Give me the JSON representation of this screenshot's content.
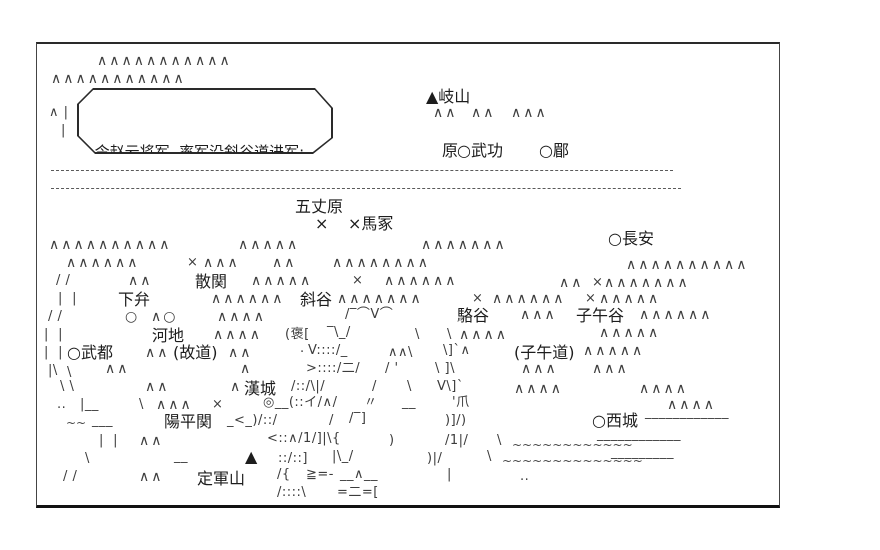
{
  "colors": {
    "ink": "#1d1d1d",
    "art": "#3c3c3c",
    "border": "#2a2a2a",
    "background": "#ffffff"
  },
  "map": {
    "frame": {
      "x": 36,
      "y": 42,
      "w": 744,
      "h": 466
    },
    "speech_bubble": {
      "x": 76,
      "y": 86,
      "w": 256,
      "h": 66,
      "lines": [
        "令赵云将军, 率军沿斜谷道进军;",
        "为疑兵, 吸引魏军主力。"
      ]
    },
    "river_lines": [
      {
        "x": 50,
        "y": 168,
        "w": 622
      },
      {
        "x": 50,
        "y": 186,
        "w": 630
      }
    ],
    "labels": [
      {
        "id": "qishan",
        "text": "▲岐山",
        "x": 425,
        "y": 86
      },
      {
        "id": "yuan",
        "text": "原",
        "x": 441,
        "y": 140
      },
      {
        "id": "wugong",
        "text": "○武功",
        "x": 456,
        "y": 140
      },
      {
        "id": "mei",
        "text": "○郿",
        "x": 538,
        "y": 140
      },
      {
        "id": "wuzhangyuan",
        "text": "五丈原",
        "x": 294,
        "y": 196
      },
      {
        "id": "mark-west",
        "text": "×",
        "x": 314,
        "y": 213
      },
      {
        "id": "mazhong",
        "text": "×馬冢",
        "x": 347,
        "y": 213
      },
      {
        "id": "changan",
        "text": "○長安",
        "x": 607,
        "y": 228
      },
      {
        "id": "sanguan",
        "text": "散関",
        "x": 194,
        "y": 271
      },
      {
        "id": "xiabian",
        "text": "下弁",
        "x": 117,
        "y": 289
      },
      {
        "id": "xiegu",
        "text": "斜谷",
        "x": 299,
        "y": 289
      },
      {
        "id": "luogu",
        "text": "駱谷",
        "x": 456,
        "y": 305
      },
      {
        "id": "ziwugu",
        "text": "子午谷",
        "x": 575,
        "y": 305
      },
      {
        "id": "hedi",
        "text": "河地",
        "x": 151,
        "y": 325
      },
      {
        "id": "wudu",
        "text": "○武都",
        "x": 66,
        "y": 342
      },
      {
        "id": "gudao",
        "text": "(故道)",
        "x": 172,
        "y": 342
      },
      {
        "id": "ziwudao",
        "text": "(子午道)",
        "x": 513,
        "y": 342
      },
      {
        "id": "hancheng",
        "text": "漢城",
        "x": 243,
        "y": 378
      },
      {
        "id": "yangpingguan",
        "text": "陽平関",
        "x": 163,
        "y": 411
      },
      {
        "id": "xicheng",
        "text": "○西城",
        "x": 591,
        "y": 410
      },
      {
        "id": "dingjunshan-mark",
        "text": "▲",
        "x": 244,
        "y": 446
      },
      {
        "id": "dingjunshan",
        "text": "定軍山",
        "x": 196,
        "y": 468
      }
    ],
    "art": [
      {
        "x": 96,
        "y": 52,
        "t": "∧∧∧∧∧∧∧∧∧∧∧"
      },
      {
        "x": 50,
        "y": 70,
        "t": "∧∧∧∧∧∧∧∧∧∧∧"
      },
      {
        "x": 48,
        "y": 104,
        "t": "∧ |"
      },
      {
        "x": 60,
        "y": 122,
        "t": "|"
      },
      {
        "x": 432,
        "y": 104,
        "t": "∧∧"
      },
      {
        "x": 470,
        "y": 104,
        "t": "∧∧"
      },
      {
        "x": 510,
        "y": 104,
        "t": "∧∧∧"
      },
      {
        "x": 48,
        "y": 236,
        "t": "∧∧∧∧∧∧∧∧∧∧"
      },
      {
        "x": 237,
        "y": 236,
        "t": "∧∧∧∧∧"
      },
      {
        "x": 420,
        "y": 236,
        "t": "∧∧∧∧∧∧∧"
      },
      {
        "x": 65,
        "y": 254,
        "t": "∧∧∧∧∧∧"
      },
      {
        "x": 186,
        "y": 254,
        "t": "×"
      },
      {
        "x": 202,
        "y": 254,
        "t": "∧∧∧"
      },
      {
        "x": 271,
        "y": 254,
        "t": "∧∧"
      },
      {
        "x": 331,
        "y": 254,
        "t": "∧∧∧∧∧∧∧∧"
      },
      {
        "x": 625,
        "y": 256,
        "t": "∧∧∧∧∧∧∧∧∧∧"
      },
      {
        "x": 55,
        "y": 272,
        "t": "/ /"
      },
      {
        "x": 127,
        "y": 272,
        "t": "∧∧"
      },
      {
        "x": 250,
        "y": 272,
        "t": "∧∧∧∧∧"
      },
      {
        "x": 351,
        "y": 272,
        "t": "×"
      },
      {
        "x": 383,
        "y": 272,
        "t": "∧∧∧∧∧∧"
      },
      {
        "x": 558,
        "y": 274,
        "t": "∧∧"
      },
      {
        "x": 591,
        "y": 274,
        "t": "×"
      },
      {
        "x": 603,
        "y": 274,
        "t": "∧∧∧∧∧∧∧"
      },
      {
        "x": 57,
        "y": 290,
        "t": "|  |"
      },
      {
        "x": 210,
        "y": 290,
        "t": "∧∧∧∧∧∧"
      },
      {
        "x": 336,
        "y": 290,
        "t": "∧∧∧∧∧∧∧"
      },
      {
        "x": 471,
        "y": 290,
        "t": "×"
      },
      {
        "x": 491,
        "y": 290,
        "t": "∧∧∧∧∧∧"
      },
      {
        "x": 584,
        "y": 290,
        "t": "×"
      },
      {
        "x": 598,
        "y": 290,
        "t": "∧∧∧∧∧"
      },
      {
        "x": 47,
        "y": 308,
        "t": "/ /"
      },
      {
        "x": 124,
        "y": 308,
        "t": "○"
      },
      {
        "x": 150,
        "y": 308,
        "t": "∧○"
      },
      {
        "x": 216,
        "y": 308,
        "t": "∧∧∧∧"
      },
      {
        "x": 344,
        "y": 306,
        "t": "/‾⌒V⌒"
      },
      {
        "x": 519,
        "y": 306,
        "t": "∧∧∧"
      },
      {
        "x": 638,
        "y": 306,
        "t": "∧∧∧∧∧∧"
      },
      {
        "x": 43,
        "y": 326,
        "t": "|  |"
      },
      {
        "x": 212,
        "y": 326,
        "t": "∧∧∧∧"
      },
      {
        "x": 284,
        "y": 326,
        "t": "(褒["
      },
      {
        "x": 326,
        "y": 324,
        "t": "‾\\_/"
      },
      {
        "x": 414,
        "y": 326,
        "t": "\\"
      },
      {
        "x": 446,
        "y": 326,
        "t": "\\"
      },
      {
        "x": 458,
        "y": 326,
        "t": "∧∧∧∧"
      },
      {
        "x": 598,
        "y": 324,
        "t": "∧∧∧∧∧"
      },
      {
        "x": 43,
        "y": 344,
        "t": "|  |"
      },
      {
        "x": 144,
        "y": 344,
        "t": "∧∧"
      },
      {
        "x": 227,
        "y": 344,
        "t": "∧∧"
      },
      {
        "x": 299,
        "y": 344,
        "t": "·"
      },
      {
        "x": 307,
        "y": 342,
        "t": "V::::/_"
      },
      {
        "x": 387,
        "y": 344,
        "t": "∧∧\\"
      },
      {
        "x": 442,
        "y": 342,
        "t": "\\]`∧"
      },
      {
        "x": 582,
        "y": 342,
        "t": "∧∧∧∧∧"
      },
      {
        "x": 47,
        "y": 362,
        "t": "|\\"
      },
      {
        "x": 66,
        "y": 364,
        "t": "\\"
      },
      {
        "x": 104,
        "y": 360,
        "t": "∧∧"
      },
      {
        "x": 239,
        "y": 360,
        "t": "∧"
      },
      {
        "x": 305,
        "y": 360,
        "t": ">::::/二/"
      },
      {
        "x": 384,
        "y": 360,
        "t": "/ '"
      },
      {
        "x": 434,
        "y": 360,
        "t": "\\ ]\\"
      },
      {
        "x": 520,
        "y": 360,
        "t": "∧∧∧"
      },
      {
        "x": 591,
        "y": 360,
        "t": "∧∧∧"
      },
      {
        "x": 59,
        "y": 378,
        "t": "\\ \\"
      },
      {
        "x": 144,
        "y": 378,
        "t": "∧∧"
      },
      {
        "x": 229,
        "y": 378,
        "t": "∧"
      },
      {
        "x": 290,
        "y": 378,
        "t": "/::/\\|/"
      },
      {
        "x": 371,
        "y": 378,
        "t": "/"
      },
      {
        "x": 406,
        "y": 378,
        "t": "\\"
      },
      {
        "x": 436,
        "y": 378,
        "t": "V\\]`"
      },
      {
        "x": 513,
        "y": 380,
        "t": "∧∧∧∧"
      },
      {
        "x": 638,
        "y": 380,
        "t": "∧∧∧∧"
      },
      {
        "x": 56,
        "y": 396,
        "t": ".."
      },
      {
        "x": 79,
        "y": 396,
        "t": "|__"
      },
      {
        "x": 138,
        "y": 396,
        "t": "\\"
      },
      {
        "x": 155,
        "y": 396,
        "t": "∧∧∧"
      },
      {
        "x": 211,
        "y": 396,
        "t": "×"
      },
      {
        "x": 262,
        "y": 394,
        "t": "◎__(::イ/∧/"
      },
      {
        "x": 363,
        "y": 394,
        "t": "〃"
      },
      {
        "x": 401,
        "y": 394,
        "t": "__"
      },
      {
        "x": 451,
        "y": 394,
        "t": "'爪"
      },
      {
        "x": 666,
        "y": 396,
        "t": "∧∧∧∧"
      },
      {
        "x": 65,
        "y": 414,
        "t": "~~"
      },
      {
        "x": 91,
        "y": 412,
        "t": "___"
      },
      {
        "x": 226,
        "y": 412,
        "t": "_<_)/::/"
      },
      {
        "x": 328,
        "y": 412,
        "t": "/"
      },
      {
        "x": 348,
        "y": 410,
        "t": "/‾]"
      },
      {
        "x": 444,
        "y": 412,
        "t": ")]/)"
      },
      {
        "x": 644,
        "y": 404,
        "t": "____________"
      },
      {
        "x": 98,
        "y": 432,
        "t": "|  |"
      },
      {
        "x": 138,
        "y": 432,
        "t": "∧∧"
      },
      {
        "x": 266,
        "y": 430,
        "t": "<::∧/1/]|\\{"
      },
      {
        "x": 388,
        "y": 432,
        "t": ")"
      },
      {
        "x": 444,
        "y": 432,
        "t": "/1|/"
      },
      {
        "x": 496,
        "y": 432,
        "t": "\\"
      },
      {
        "x": 511,
        "y": 436,
        "t": "~~~~~~~~~~~~"
      },
      {
        "x": 596,
        "y": 426,
        "t": "____________"
      },
      {
        "x": 84,
        "y": 450,
        "t": "\\"
      },
      {
        "x": 173,
        "y": 448,
        "t": "__"
      },
      {
        "x": 277,
        "y": 450,
        "t": "::/::]"
      },
      {
        "x": 331,
        "y": 448,
        "t": "|\\_/"
      },
      {
        "x": 426,
        "y": 450,
        "t": ")|/"
      },
      {
        "x": 486,
        "y": 448,
        "t": "\\"
      },
      {
        "x": 501,
        "y": 452,
        "t": "~~~~~~~~~~~~~~"
      },
      {
        "x": 610,
        "y": 444,
        "t": "_________"
      },
      {
        "x": 62,
        "y": 468,
        "t": "/ /"
      },
      {
        "x": 138,
        "y": 468,
        "t": "∧∧"
      },
      {
        "x": 276,
        "y": 466,
        "t": "/{"
      },
      {
        "x": 305,
        "y": 466,
        "t": "≧=-"
      },
      {
        "x": 339,
        "y": 466,
        "t": "__∧__"
      },
      {
        "x": 446,
        "y": 466,
        "t": "|"
      },
      {
        "x": 519,
        "y": 468,
        "t": ".."
      },
      {
        "x": 276,
        "y": 484,
        "t": "/::::\\"
      },
      {
        "x": 336,
        "y": 484,
        "t": "=二=["
      }
    ]
  }
}
